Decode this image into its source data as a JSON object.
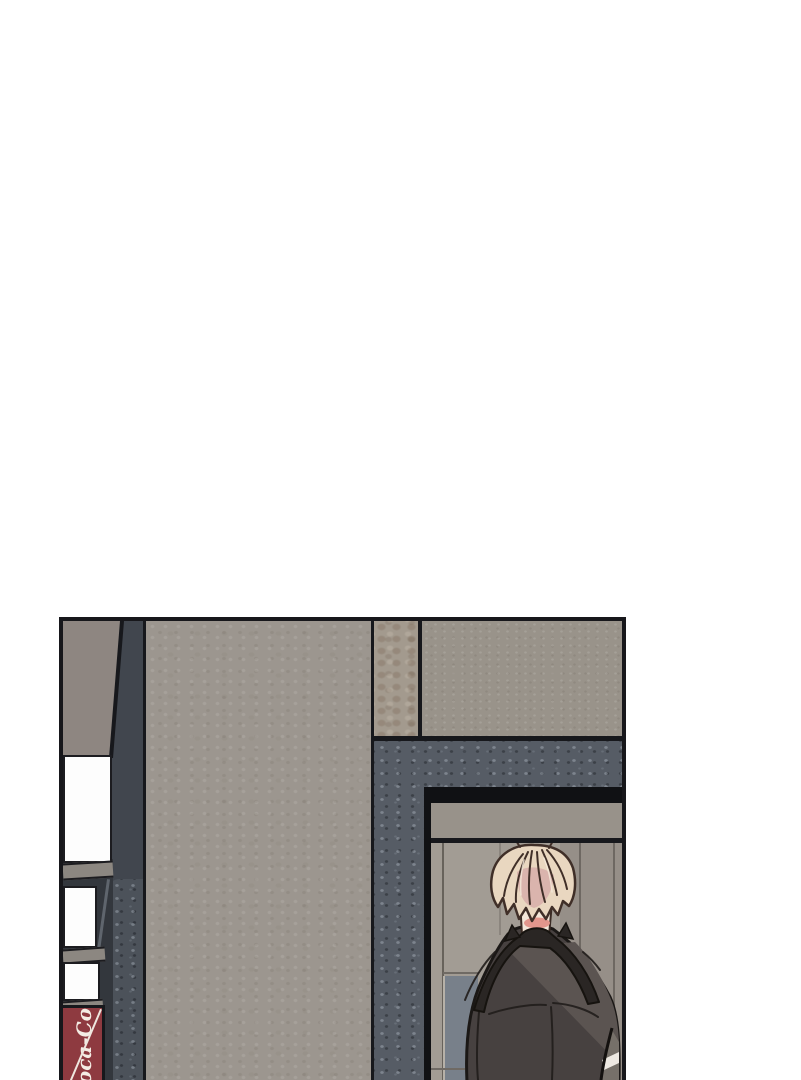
{
  "scene": {
    "type": "webtoon-comic-panel",
    "description": "Single borderless-bottom comic panel at page bottom: a blond man seen from behind, wearing a dark coat, walking into a doorway of a grey building beside a Coca-Cola vending machine.",
    "page_background": "#ffffff"
  },
  "sign": {
    "brand_text": "Coca-Cola"
  },
  "colors": {
    "panel_border": "#17171b",
    "wall_taupe": "#8e8681",
    "pillar_dark": "#41464e",
    "pillar_dark_speckled": "#4c525a",
    "machine_bg_dark": "#33373d",
    "machine_white": "#fdfdfd",
    "shelf_grey": "#8c8781",
    "coke_red": "#8e3a40",
    "coke_script": "#f4ece4",
    "column_beige": "#9c968f",
    "strip_mottled": "#a39a8e",
    "wall_top_grey": "#99938a",
    "door_surround": "#565c65",
    "door_frame_black": "#101114",
    "lintel_grey": "#98928a",
    "interior_wall": "#a29c94",
    "interior_panel": "#968f88",
    "interior_glass": "#78808a",
    "hair_blond": "#e9d7c0",
    "hair_shade": "#dab4ad",
    "skin": "#f3e6d8",
    "blush": "#e2968c",
    "coat_dark": "#474140",
    "coat_highlight": "#5b5451",
    "collar_dark": "#2a2624",
    "gap_light": "#767069",
    "gap_white": "#eee9e2"
  }
}
